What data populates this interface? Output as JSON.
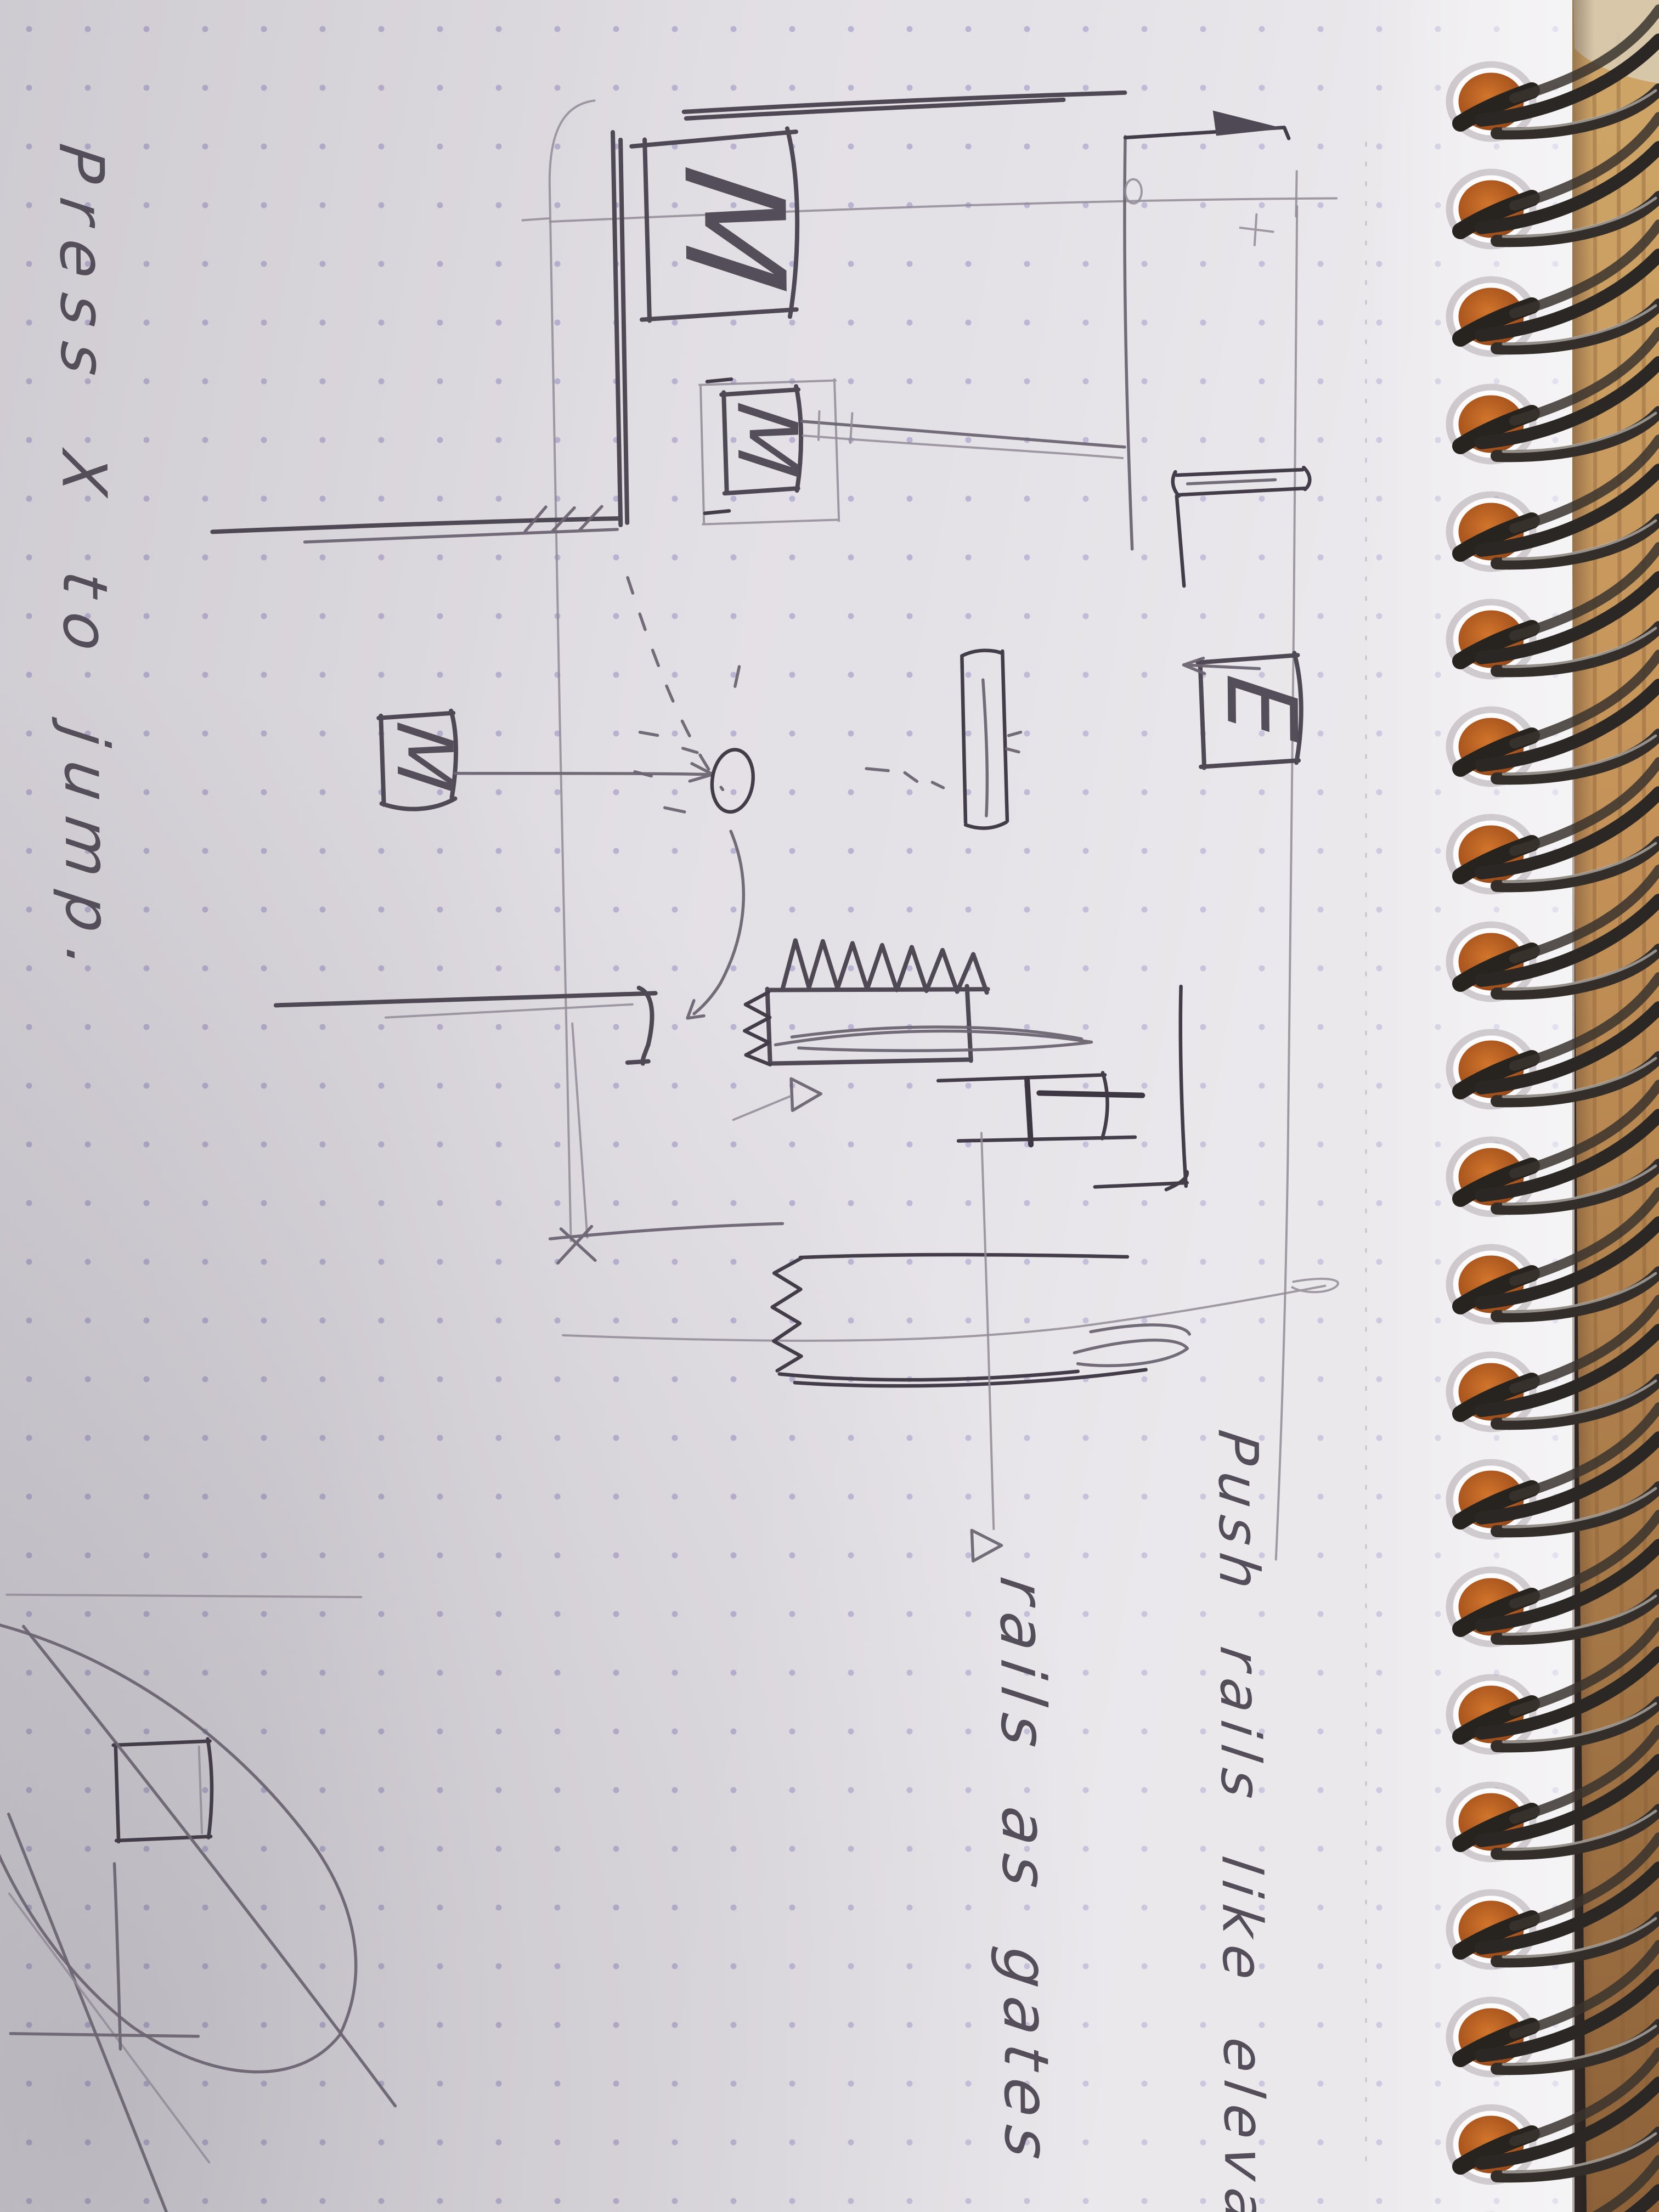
{
  "notes": {
    "jump_caption": "Press X to jump.",
    "rails_elevators": "Push rails like elevat",
    "rails_gates": "rails as gates"
  },
  "sketch_labels": {
    "box_top_left": "M",
    "box_platform": "M",
    "box_feeder": "M",
    "box_exit": "E"
  },
  "colors": {
    "paper": "#e4e1e6",
    "grid_dot": "#8f88c0",
    "pencil": "#4f4955",
    "pencil_faint": "#908b97",
    "wood": "#b9854b",
    "coil_wire": "#2b2724",
    "hole_orange": "#c4671f"
  }
}
